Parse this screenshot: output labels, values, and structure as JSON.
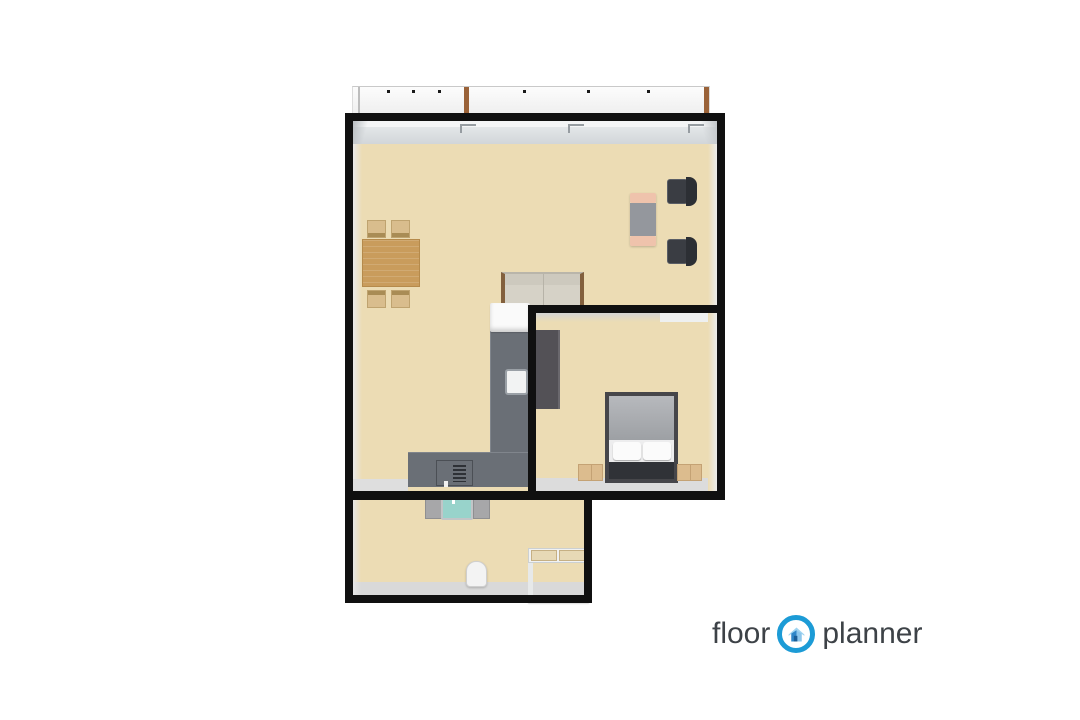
{
  "page": {
    "background": "#ffffff",
    "content": "3D rendered apartment floor plan, top-down view"
  },
  "logo": {
    "word1": "floor",
    "word2": "planner",
    "icon": "floorplanner-house-icon"
  },
  "colors": {
    "wall": "#101010",
    "floor": "#ecdcb4",
    "counter": "#6a6f76",
    "fridge": "#fafafa",
    "wardrobe": "#535156",
    "bedframe": "#46464a",
    "bedfoot": "#303237",
    "wood": "#c99c5c",
    "chairTan": "#d9bd8d",
    "sofaBody": "#d6d2c7",
    "sofaWood": "#83603d",
    "deskMid": "#94979d",
    "deskCap": "#efc3ac",
    "chairDark": "#3a3d43",
    "basin": "#98d3cb",
    "vanity": "#a7a7a9",
    "toilet": "#f3f3f3",
    "logoText": "#3d4247",
    "logoBlue": "#1c9bd6"
  },
  "floorplan": {
    "balcony": {
      "name": "balcony",
      "railing_posts": 2,
      "balusters": 6
    },
    "rooms": [
      {
        "name": "living-room-with-kitchen",
        "furniture": [
          "dining-table",
          "dining-chair x4",
          "sofa",
          "desk",
          "office-chair x2",
          "l-shaped-kitchen-counter",
          "fridge",
          "sink",
          "stove"
        ]
      },
      {
        "name": "bedroom",
        "furniture": [
          "double-bed",
          "nightstand x2",
          "wardrobe"
        ]
      },
      {
        "name": "bathroom",
        "furniture": [
          "vanity-with-basin",
          "toilet",
          "storage-shelf"
        ]
      }
    ]
  }
}
